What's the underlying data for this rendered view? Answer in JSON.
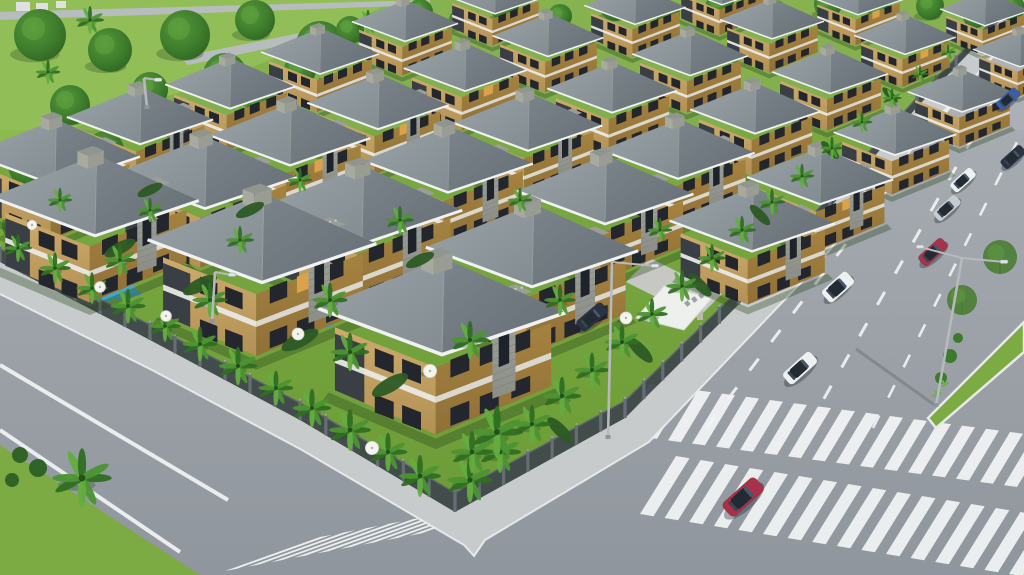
{
  "scene": {
    "description": "Aerial 3D architectural rendering of a gated villa community with rows of identical two-story villas, gardens with palm trees and pools, perimeter fence, sidewalks, and two asphalt roads with crosswalks, a planted median and cars",
    "width": 1024,
    "height": 575
  },
  "palette": {
    "asphalt_top": "#adb2b7",
    "asphalt_bottom": "#90969d",
    "lawn": "#76a43e",
    "lawn_dark": "#668f33",
    "park_lawn": "#8cba4e",
    "grass_corner": "#7cab43",
    "tree_dark": "#2e6323",
    "tree_mid": "#3e7d2c",
    "tree_light": "#55983a",
    "palm_dark": "#2f6e22",
    "palm_mid": "#4c9433",
    "palm_light": "#63ad3f",
    "palm_trunk": "#8d7b5c",
    "roof_light": "#9aa3a8",
    "roof_light2": "#838c91",
    "roof_dark": "#7b848a",
    "roof_dark2": "#656e74",
    "fascia": "#f0f2f1",
    "wall_front": "#cdab6d",
    "wall_front2": "#b39053",
    "wall_side": "#a5823f",
    "wall_side2": "#8f7038",
    "wall_band": "#e9e9e4",
    "wall_accent": "#3a3f45",
    "window": "#23272d",
    "window_lit": "#d9a24b",
    "stone": "#a3a69e",
    "stone2": "#8b8e86",
    "pebble": "#c9ccc4",
    "sidewalk": "#c8cbcb",
    "curb": "#eceeee",
    "marking": "#f2f4f4",
    "fence": "#3f474d",
    "fence_pillar": "#666e74",
    "fence_cap": "#9ba2a7",
    "pool_light": "#5fc0da",
    "pool_dark": "#2f8fb3",
    "canopy": "#eef0ed",
    "sign_letter": "#9aa0a5",
    "car_white": "#eef1f2",
    "car_red": "#a8324a",
    "car_silver": "#c7ccd0",
    "car_navy": "#2a3342",
    "car_blue": "#3a5fa8",
    "car_glass": "#222b33",
    "pole": "#b6babd",
    "umbrella": "#f4f4ef",
    "far_building": "#dde0e0"
  },
  "geometry": {
    "fence_left": [
      [
        0,
        262
      ],
      [
        150,
        340
      ],
      [
        300,
        420
      ],
      [
        455,
        512
      ]
    ],
    "fence_east": [
      [
        455,
        512
      ],
      [
        625,
        418
      ],
      [
        795,
        248
      ],
      [
        917,
        107
      ],
      [
        1015,
        5
      ]
    ],
    "sidewalk_outer": [
      [
        0,
        294
      ],
      [
        152,
        370
      ],
      [
        302,
        450
      ],
      [
        464,
        545
      ],
      [
        474,
        556
      ],
      [
        485,
        540
      ],
      [
        649,
        442
      ],
      [
        815,
        268
      ],
      [
        933,
        123
      ],
      [
        1028,
        18
      ]
    ],
    "compound_poly": [
      [
        0,
        0
      ],
      [
        1015,
        0
      ],
      [
        917,
        107
      ],
      [
        795,
        248
      ],
      [
        625,
        418
      ],
      [
        455,
        512
      ],
      [
        300,
        420
      ],
      [
        150,
        340
      ],
      [
        0,
        262
      ]
    ],
    "park_poly": [
      [
        0,
        0
      ],
      [
        395,
        0
      ],
      [
        320,
        40
      ],
      [
        225,
        78
      ],
      [
        130,
        108
      ],
      [
        40,
        140
      ],
      [
        0,
        160
      ]
    ],
    "grass_corner_poly": [
      [
        0,
        445
      ],
      [
        200,
        575
      ],
      [
        0,
        575
      ]
    ],
    "median_poly": [
      [
        928,
        418
      ],
      [
        1024,
        322
      ],
      [
        1024,
        352
      ],
      [
        936,
        428
      ]
    ],
    "park_paths": [
      [
        [
          0,
          12
        ],
        [
          430,
          0
        ],
        [
          430,
          5
        ],
        [
          0,
          20
        ]
      ],
      [
        [
          180,
          57
        ],
        [
          300,
          33
        ],
        [
          308,
          40
        ],
        [
          188,
          65
        ]
      ]
    ],
    "far_buildings": [
      [
        16,
        2,
        14,
        9
      ],
      [
        36,
        3,
        12,
        8
      ],
      [
        56,
        1,
        10,
        7
      ]
    ],
    "driveway": [
      [
        698,
        318
      ],
      [
        722,
        294
      ],
      [
        650,
        258
      ],
      [
        626,
        282
      ]
    ],
    "canopy": [
      [
        636,
        318
      ],
      [
        664,
        286
      ],
      [
        712,
        298
      ],
      [
        684,
        330
      ]
    ],
    "gate_pillars": [
      [
        700,
        318
      ],
      [
        732,
        288
      ]
    ],
    "solid_lines": [
      [
        0,
        365,
        228,
        500
      ],
      [
        0,
        430,
        180,
        552
      ]
    ],
    "dash_lines": [
      {
        "x1": 706,
        "y1": 428,
        "x2": 958,
        "y2": 96,
        "dash": 15,
        "gap": 21,
        "w": 3
      },
      {
        "x1": 806,
        "y1": 430,
        "x2": 1000,
        "y2": 90,
        "dash": 15,
        "gap": 21,
        "w": 3
      },
      {
        "x1": 873,
        "y1": 428,
        "x2": 1024,
        "y2": 128,
        "dash": 14,
        "gap": 20,
        "w": 2.6
      }
    ],
    "crosswalks": [
      {
        "n": 9,
        "bx": 225,
        "by": 571,
        "sx": 23,
        "sy": -4.4,
        "vx": 95,
        "vy": -34,
        "tx": 12,
        "ty": -2.3
      },
      {
        "n": 17,
        "bx": 620,
        "by": 434,
        "sx": 24,
        "sy": 3.2,
        "vx": 30,
        "vy": -50,
        "tx": 13,
        "ty": 1.7
      },
      {
        "n": 17,
        "bx": 640,
        "by": 514,
        "sx": 24.6,
        "sy": 4,
        "vx": 36,
        "vy": -58,
        "tx": 13.5,
        "ty": 2.2
      }
    ]
  },
  "villas": [
    [
      722,
      -16,
      0.4
    ],
    [
      858,
      -6,
      0.4
    ],
    [
      985,
      6,
      0.38
    ],
    [
      495,
      -8,
      0.42
    ],
    [
      635,
      2,
      0.43
    ],
    [
      772,
      16,
      0.44
    ],
    [
      905,
      32,
      0.43
    ],
    [
      1020,
      46,
      0.4
    ],
    [
      405,
      18,
      0.45
    ],
    [
      548,
      32,
      0.47
    ],
    [
      690,
      50,
      0.49
    ],
    [
      830,
      68,
      0.49
    ],
    [
      962,
      88,
      0.46
    ],
    [
      320,
      48,
      0.5
    ],
    [
      465,
      64,
      0.52
    ],
    [
      612,
      84,
      0.55
    ],
    [
      755,
      105,
      0.55
    ],
    [
      895,
      128,
      0.52
    ],
    [
      230,
      80,
      0.55
    ],
    [
      378,
      98,
      0.6
    ],
    [
      528,
      118,
      0.63
    ],
    [
      678,
      145,
      0.65
    ],
    [
      820,
      172,
      0.62
    ],
    [
      140,
      112,
      0.62
    ],
    [
      290,
      130,
      0.68
    ],
    [
      448,
      155,
      0.72
    ],
    [
      605,
      185,
      0.75
    ],
    [
      752,
      215,
      0.7
    ],
    [
      55,
      148,
      0.72
    ],
    [
      205,
      168,
      0.78
    ],
    [
      362,
      200,
      0.85
    ],
    [
      532,
      240,
      0.9
    ],
    [
      95,
      190,
      0.88
    ],
    [
      262,
      232,
      0.97
    ],
    [
      442,
      300,
      1.05
    ]
  ],
  "vegetation": {
    "top_band_trees": [
      [
        420,
        12,
        13
      ],
      [
        460,
        20,
        11
      ],
      [
        505,
        8,
        14
      ],
      [
        560,
        16,
        12
      ],
      [
        615,
        6,
        15
      ],
      [
        668,
        14,
        12
      ],
      [
        720,
        5,
        14
      ],
      [
        775,
        12,
        12
      ],
      [
        828,
        4,
        14
      ],
      [
        880,
        14,
        12
      ],
      [
        930,
        6,
        14
      ],
      [
        975,
        16,
        12
      ],
      [
        1012,
        8,
        13
      ]
    ],
    "park_trees": [
      [
        40,
        35,
        26
      ],
      [
        110,
        50,
        22
      ],
      [
        185,
        35,
        25
      ],
      [
        255,
        20,
        20
      ],
      [
        320,
        45,
        24
      ],
      [
        70,
        105,
        20
      ],
      [
        150,
        90,
        18
      ],
      [
        225,
        75,
        22
      ],
      [
        300,
        70,
        16
      ],
      [
        30,
        165,
        22
      ],
      [
        105,
        150,
        19
      ],
      [
        185,
        125,
        16
      ],
      [
        20,
        225,
        18
      ],
      [
        80,
        205,
        15
      ],
      [
        260,
        110,
        14
      ],
      [
        350,
        30,
        14
      ],
      [
        390,
        55,
        12
      ],
      [
        150,
        190,
        13
      ]
    ],
    "park_palms": [
      [
        90,
        20,
        0.8
      ],
      [
        240,
        95,
        0.8
      ],
      [
        320,
        90,
        0.7
      ],
      [
        170,
        160,
        0.8
      ],
      [
        48,
        72,
        0.7
      ],
      [
        368,
        22,
        0.7
      ],
      [
        120,
        185,
        0.7
      ]
    ],
    "fence_palms_left": [
      [
        18,
        248,
        0.8
      ],
      [
        55,
        268,
        0.9
      ],
      [
        92,
        288,
        0.9
      ],
      [
        128,
        306,
        1.0
      ],
      [
        165,
        326,
        0.9
      ],
      [
        200,
        344,
        1.0
      ],
      [
        238,
        366,
        1.1
      ],
      [
        276,
        388,
        1.0
      ],
      [
        312,
        408,
        1.1
      ],
      [
        350,
        430,
        1.2
      ],
      [
        388,
        452,
        1.1
      ],
      [
        420,
        476,
        1.2
      ]
    ],
    "fence_palms_east": [
      [
        470,
        480,
        1.3
      ],
      [
        500,
        452,
        1.2
      ],
      [
        532,
        424,
        1.1
      ],
      [
        562,
        396,
        1.1
      ],
      [
        592,
        370,
        1.0
      ],
      [
        622,
        342,
        1.0
      ],
      [
        652,
        314,
        0.9
      ],
      [
        682,
        286,
        0.9
      ],
      [
        712,
        258,
        0.8
      ],
      [
        742,
        230,
        0.8
      ],
      [
        772,
        202,
        0.75
      ],
      [
        802,
        176,
        0.7
      ],
      [
        832,
        148,
        0.65
      ],
      [
        862,
        122,
        0.6
      ],
      [
        892,
        98,
        0.55
      ],
      [
        920,
        74,
        0.5
      ],
      [
        948,
        52,
        0.45
      ]
    ],
    "garden_palms": [
      [
        120,
        260,
        0.9
      ],
      [
        210,
        300,
        1.0
      ],
      [
        330,
        300,
        1.0
      ],
      [
        350,
        352,
        1.1
      ],
      [
        470,
        340,
        1.1
      ],
      [
        240,
        240,
        0.8
      ],
      [
        400,
        220,
        0.8
      ],
      [
        560,
        300,
        0.9
      ],
      [
        300,
        180,
        0.7
      ],
      [
        150,
        210,
        0.7
      ],
      [
        520,
        200,
        0.7
      ],
      [
        660,
        230,
        0.7
      ],
      [
        60,
        200,
        0.7
      ],
      [
        497,
        432,
        1.5
      ],
      [
        472,
        452,
        1.2
      ]
    ],
    "corner_palm": [
      82,
      478,
      1.7
    ],
    "corner_bushes": [
      [
        20,
        455,
        8
      ],
      [
        38,
        468,
        9
      ],
      [
        12,
        480,
        7
      ]
    ],
    "hedges": [
      [
        120,
        248,
        -27,
        1
      ],
      [
        200,
        285,
        -27,
        1.1
      ],
      [
        300,
        340,
        -27,
        1.2
      ],
      [
        390,
        385,
        -30,
        1.2
      ],
      [
        560,
        430,
        45,
        1
      ],
      [
        640,
        350,
        45,
        1
      ],
      [
        700,
        285,
        45,
        0.9
      ],
      [
        760,
        215,
        45,
        0.8
      ],
      [
        830,
        150,
        45,
        0.7
      ],
      [
        890,
        95,
        45,
        0.6
      ],
      [
        250,
        210,
        -25,
        0.9
      ],
      [
        420,
        260,
        -25,
        0.9
      ],
      [
        150,
        190,
        -25,
        0.8
      ]
    ],
    "median_trees": [
      [
        962,
        300,
        15
      ],
      [
        1000,
        257,
        17
      ]
    ],
    "median_bushes": [
      [
        941,
        378,
        6
      ],
      [
        950,
        356,
        7
      ],
      [
        958,
        338,
        5
      ]
    ],
    "median_agaves": [
      [
        937,
        396
      ],
      [
        944,
        386
      ]
    ]
  },
  "amenities": {
    "pools": [
      [
        [
          278,
          322
        ],
        [
          322,
          314
        ],
        [
          334,
          326
        ],
        [
          290,
          335
        ]
      ],
      [
        [
          88,
          292
        ],
        [
          132,
          284
        ],
        [
          142,
          295
        ],
        [
          98,
          303
        ]
      ],
      [
        [
          18,
          208
        ],
        [
          52,
          202
        ],
        [
          60,
          211
        ],
        [
          26,
          217
        ]
      ],
      [
        [
          148,
          257
        ],
        [
          172,
          252
        ],
        [
          178,
          260
        ],
        [
          154,
          265
        ]
      ]
    ],
    "pool_people": [
      [
        306,
        325
      ],
      [
        315,
        322
      ]
    ],
    "umbrellas": [
      [
        32,
        225,
        0.8
      ],
      [
        100,
        287,
        0.9
      ],
      [
        166,
        316,
        0.9
      ],
      [
        298,
        334,
        1.0
      ],
      [
        430,
        371,
        1.1
      ],
      [
        372,
        448,
        1.1
      ],
      [
        626,
        318,
        1.0
      ]
    ]
  },
  "cars": [
    {
      "x": 838,
      "y": 287,
      "s": 0.72,
      "rot": -42,
      "color": "car_white",
      "type": "suv"
    },
    {
      "x": 800,
      "y": 368,
      "s": 0.8,
      "rot": -42,
      "color": "car_white",
      "type": "sedan"
    },
    {
      "x": 743,
      "y": 497,
      "s": 0.95,
      "rot": -42,
      "color": "car_red",
      "type": "sedan"
    },
    {
      "x": 933,
      "y": 252,
      "s": 0.68,
      "rot": -42,
      "color": "car_red",
      "type": "sedan"
    },
    {
      "x": 947,
      "y": 208,
      "s": 0.64,
      "rot": -42,
      "color": "car_silver",
      "type": "sedan"
    },
    {
      "x": 963,
      "y": 180,
      "s": 0.6,
      "rot": -42,
      "color": "car_white",
      "type": "sedan"
    },
    {
      "x": 1013,
      "y": 157,
      "s": 0.58,
      "rot": -42,
      "color": "car_navy",
      "type": "sedan"
    },
    {
      "x": 1008,
      "y": 99,
      "s": 0.55,
      "rot": -42,
      "color": "car_blue",
      "type": "sedan"
    },
    {
      "x": 592,
      "y": 317,
      "s": 0.72,
      "rot": -40,
      "color": "car_navy",
      "type": "sedan"
    }
  ],
  "street_lights": [
    {
      "bx": 936,
      "by": 406,
      "tx": 962,
      "ty": 258,
      "arms": [
        [
          920,
          247
        ],
        [
          1004,
          262
        ]
      ],
      "shadow": [
        856,
        349
      ]
    },
    {
      "bx": 608,
      "by": 438,
      "tx": 612,
      "ty": 262,
      "arms": [
        [
          655,
          266
        ]
      ],
      "shadow": null
    },
    {
      "bx": 212,
      "by": 322,
      "tx": 215,
      "ty": 272,
      "arms": [
        [
          232,
          275
        ]
      ],
      "shadow": null
    },
    {
      "bx": 147,
      "by": 108,
      "tx": 144,
      "ty": 78,
      "arms": [
        [
          158,
          80
        ]
      ],
      "shadow": null
    }
  ]
}
